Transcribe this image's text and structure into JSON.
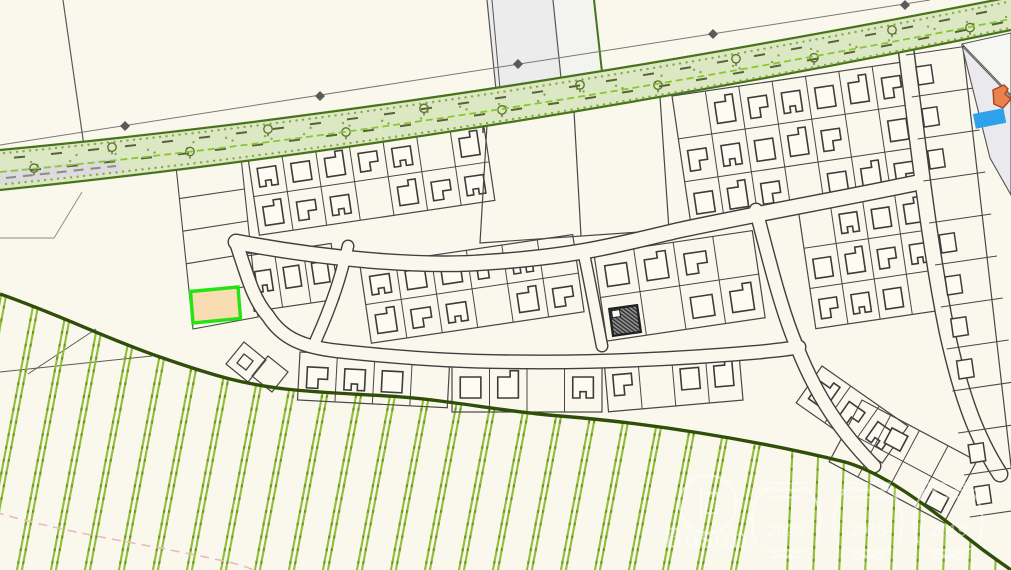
{
  "map": {
    "kind": "cadastral-parcel-map",
    "background": "#faf8ec",
    "colors": {
      "parcel_line": "#474747",
      "road_strip_fill": "#dce8c3",
      "road_strip_edge": "#47731b",
      "road_strip_dash": "#86c92e",
      "crossing_road_fill": "#ececec",
      "survey_line": "#787878",
      "selected_parcel_fill": "#f8ddb2",
      "selected_parcel_border": "#23e411",
      "building_fill": "#fdfcf3",
      "building_outline": "#3c3c3c",
      "orange_building_fill": "#e8824e",
      "orange_building_outline": "#b2441a",
      "pool_fill": "#2da1e9",
      "hatched_building_line": "#2f2f2f",
      "vineyard_row_line": "#8fbe37",
      "land_boundary": "#2f4e09",
      "contour_dashed": "#e4bdbd",
      "large_parcel_fill": "#e9e9ee"
    }
  },
  "watermark": {
    "brand": "Bosen",
    "color": "#ffffff",
    "badges": [
      {
        "year": "2023"
      },
      {
        "year": "2016"
      },
      {
        "year": "2019"
      }
    ]
  }
}
